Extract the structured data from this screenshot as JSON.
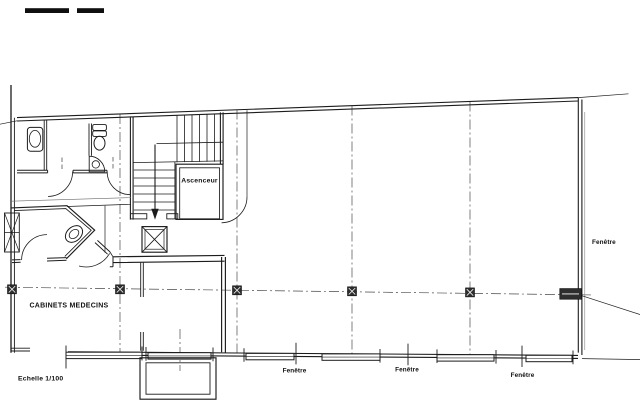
{
  "plan": {
    "rooms": {
      "offices_label": "CABINETS MEDECINS",
      "elevator_label": "Ascenceur"
    },
    "annotations": {
      "scale_label": "Echelle 1/100",
      "window_right_label": "Fenêtre",
      "window_bottom_labels": [
        "Fenêtre",
        "Fenêtre",
        "Fenêtre"
      ]
    },
    "colors": {
      "ink": "#1c1c1c",
      "paper": "#ffffff",
      "grid": "#4a4a4a"
    }
  }
}
